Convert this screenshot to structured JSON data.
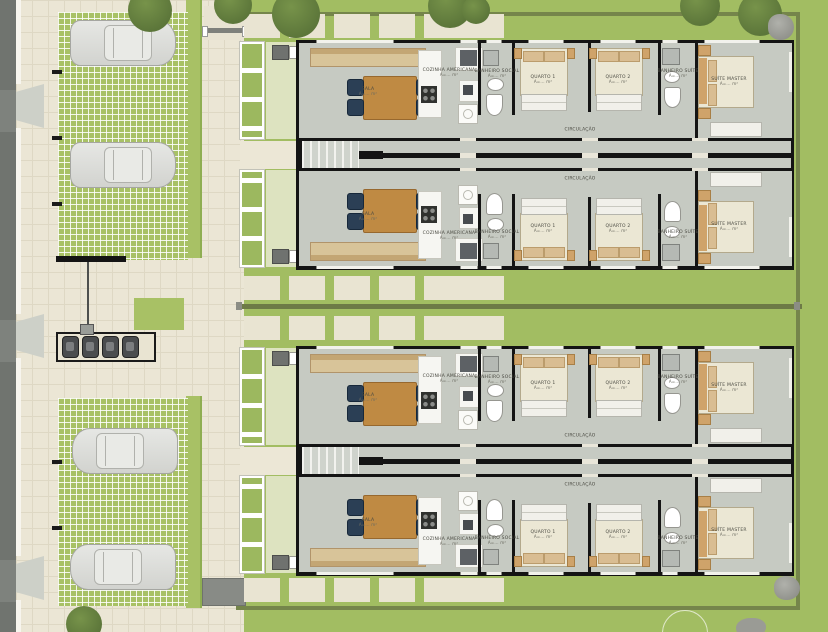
{
  "plan": {
    "title": "Residential site / floor plan",
    "rooms": {
      "sala": {
        "name": "SALA",
        "area": "A=... m²"
      },
      "cozinha": {
        "name": "COZINHA AMERICANA",
        "area": "A=... m²"
      },
      "banheiro_social": {
        "name": "BANHEIRO SOCIAL",
        "area": "A=... m²"
      },
      "quarto1": {
        "name": "QUARTO 1",
        "area": "A=... m²"
      },
      "quarto2": {
        "name": "QUARTO 2",
        "area": "A=... m²"
      },
      "banheiro_suite": {
        "name": "BANHEIRO SUÍTE",
        "area": "A=... m²"
      },
      "suite_master": {
        "name": "SUÍTE MASTER",
        "area": "A=... m²"
      },
      "circulacao": {
        "name": "CIRCULAÇÃO",
        "area": "A=... m²"
      }
    },
    "units": {
      "count": 4,
      "buildings": 2
    },
    "parking": {
      "cars": 4,
      "motorcycles": 4
    },
    "colors": {
      "lawn": "#a2bd62",
      "paving": "#ebe6d5",
      "permeable_paver": "#a8c165",
      "floor": "#c6cac2",
      "wall": "#141414",
      "road": "#70746f",
      "wood": "#bf8a43",
      "chair": "#2b3f55",
      "sofa": "#d8c499",
      "bed": "#ebe7d4",
      "accent_tan": "#cfa36a",
      "hedge": "#75854b"
    }
  }
}
